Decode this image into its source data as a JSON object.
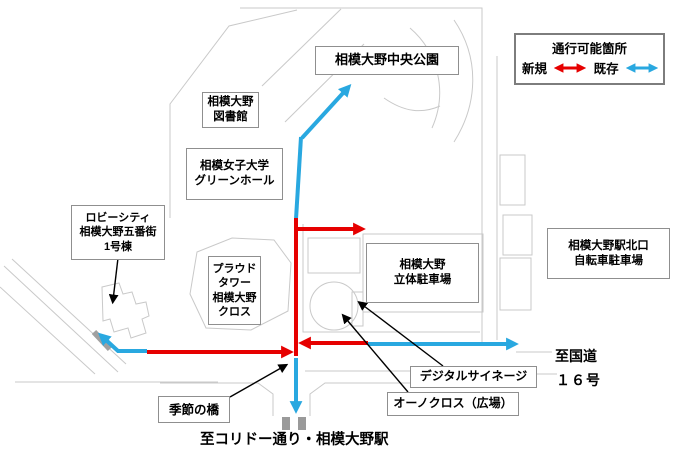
{
  "legend": {
    "title": "通行可能箇所",
    "items": [
      {
        "name": "new",
        "label": "新規",
        "color": "#e60000"
      },
      {
        "name": "existing",
        "label": "既存",
        "color": "#29a8e0"
      }
    ]
  },
  "labels": {
    "central_park": "相模大野中央公園",
    "library": "相模大野\n図書館",
    "green_hall": "相模女子大学\nグリーンホール",
    "lobby_city": "ロビーシティ\n相模大野五番街\n1号棟",
    "proud_tower": "プラウド\nタワー\n相模大野\nクロス",
    "parking": "相模大野\n立体駐車場",
    "bicycle_parking": "相模大野駅北口\n自転車駐車場",
    "digital_signage": "デジタルサイネージ",
    "ohno_cross": "オーノクロス（広場）",
    "seasonal_bridge": "季節の橋",
    "to_route16_line1": "至国道",
    "to_route16_line2": "１６号",
    "to_corridor": "至コリドー通り・相模大野駅"
  }
}
